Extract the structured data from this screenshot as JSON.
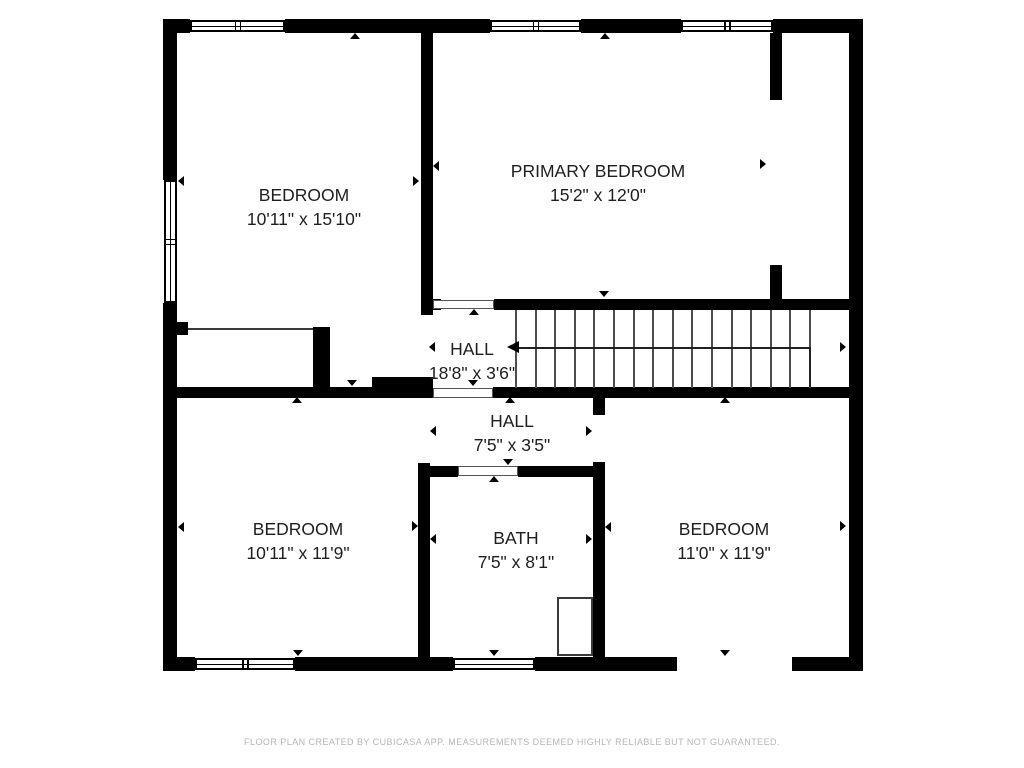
{
  "footer": {
    "text": "FLOOR PLAN CREATED BY CUBICASA APP. MEASUREMENTS DEEMED HIGHLY RELIABLE BUT NOT GUARANTEED."
  },
  "rooms": [
    {
      "name": "BEDROOM",
      "dims": "10'11\" x 15'10\"",
      "cx": 304,
      "cy": 207
    },
    {
      "name": "PRIMARY BEDROOM",
      "dims": "15'2\" x 12'0\"",
      "cx": 598,
      "cy": 183
    },
    {
      "name": "HALL",
      "dims": "18'8\" x 3'6\"",
      "cx": 472,
      "cy": 361
    },
    {
      "name": "HALL",
      "dims": "7'5\" x 3'5\"",
      "cx": 512,
      "cy": 433
    },
    {
      "name": "BATH",
      "dims": "7'5\" x 8'1\"",
      "cx": 516,
      "cy": 550
    },
    {
      "name": "BEDROOM",
      "dims": "10'11\" x 11'9\"",
      "cx": 298,
      "cy": 541
    },
    {
      "name": "BEDROOM",
      "dims": "11'0\" x 11'9\"",
      "cx": 724,
      "cy": 541
    }
  ],
  "colors": {
    "wall": "#000000",
    "thin_line": "#4d4d4d",
    "label": "#1e1e1e",
    "footer_text": "#b5b5b5",
    "background": "#ffffff"
  },
  "plan": {
    "walls": [
      [
        163,
        19,
        27,
        14
      ],
      [
        285,
        19,
        205,
        14
      ],
      [
        581,
        19,
        100,
        14
      ],
      [
        773,
        19,
        90,
        14
      ],
      [
        163,
        19,
        14,
        161
      ],
      [
        163,
        303,
        14,
        368
      ],
      [
        849,
        19,
        14,
        652
      ],
      [
        163,
        657,
        32,
        14
      ],
      [
        295,
        657,
        158,
        14
      ],
      [
        535,
        657,
        142,
        14
      ],
      [
        792,
        657,
        71,
        14
      ],
      [
        421,
        33,
        12,
        282
      ],
      [
        433,
        299,
        8,
        11
      ],
      [
        494,
        299,
        355,
        11
      ],
      [
        770,
        33,
        12,
        67
      ],
      [
        770,
        265,
        12,
        45
      ],
      [
        175,
        322,
        13,
        13
      ],
      [
        313,
        327,
        17,
        71
      ],
      [
        163,
        387,
        209,
        11
      ],
      [
        372,
        377,
        61,
        21
      ],
      [
        493,
        387,
        356,
        11
      ],
      [
        418,
        463,
        12,
        194
      ],
      [
        430,
        466,
        28,
        11
      ],
      [
        518,
        466,
        87,
        11
      ],
      [
        593,
        398,
        12,
        17
      ],
      [
        593,
        462,
        12,
        195
      ]
    ],
    "doors": [
      [
        433,
        300,
        61,
        9
      ],
      [
        433,
        388,
        60,
        10
      ],
      [
        458,
        466,
        60,
        10
      ]
    ],
    "thin_lines": [
      [
        188,
        328,
        125,
        2
      ]
    ],
    "fixtures": [
      [
        557,
        597,
        36,
        59
      ]
    ],
    "windows": [
      {
        "x": 190,
        "y": 20,
        "w": 95,
        "h": 12,
        "o": "h",
        "div": true
      },
      {
        "x": 490,
        "y": 20,
        "w": 91,
        "h": 12,
        "o": "h",
        "div": true
      },
      {
        "x": 681,
        "y": 20,
        "w": 92,
        "h": 12,
        "o": "h",
        "div": true
      },
      {
        "x": 164,
        "y": 180,
        "w": 13,
        "h": 123,
        "o": "v",
        "div": true
      },
      {
        "x": 195,
        "y": 658,
        "w": 100,
        "h": 12,
        "o": "h",
        "div": true
      },
      {
        "x": 453,
        "y": 658,
        "w": 82,
        "h": 12,
        "o": "h",
        "div": false
      }
    ],
    "stairs": {
      "tread_x0": 515,
      "tread_dx": 19.6,
      "tread_count": 16,
      "tread_y": 310,
      "tread_h": 78,
      "run_line": {
        "x1": 517,
        "x2": 809,
        "y": 347
      },
      "turn_line": {
        "x": 809,
        "y1": 347,
        "y2": 387
      },
      "head": {
        "x": 507,
        "y": 341
      }
    },
    "arrows": [
      [
        355,
        36,
        "up"
      ],
      [
        605,
        36,
        "up"
      ],
      [
        181,
        181,
        "left"
      ],
      [
        416,
        181,
        "right"
      ],
      [
        436,
        166,
        "left"
      ],
      [
        763,
        164,
        "right"
      ],
      [
        604,
        294,
        "down"
      ],
      [
        474,
        312,
        "up"
      ],
      [
        432,
        347,
        "left"
      ],
      [
        843,
        347,
        "right"
      ],
      [
        352,
        383,
        "down"
      ],
      [
        473,
        383,
        "down"
      ],
      [
        510,
        400,
        "up"
      ],
      [
        433,
        431,
        "left"
      ],
      [
        589,
        431,
        "right"
      ],
      [
        508,
        462,
        "down"
      ],
      [
        494,
        479,
        "up"
      ],
      [
        433,
        539,
        "left"
      ],
      [
        589,
        539,
        "right"
      ],
      [
        494,
        653,
        "down"
      ],
      [
        297,
        400,
        "up"
      ],
      [
        181,
        527,
        "left"
      ],
      [
        415,
        526,
        "right"
      ],
      [
        298,
        653,
        "down"
      ],
      [
        725,
        400,
        "up"
      ],
      [
        608,
        527,
        "left"
      ],
      [
        843,
        526,
        "right"
      ],
      [
        725,
        653,
        "down"
      ]
    ]
  }
}
